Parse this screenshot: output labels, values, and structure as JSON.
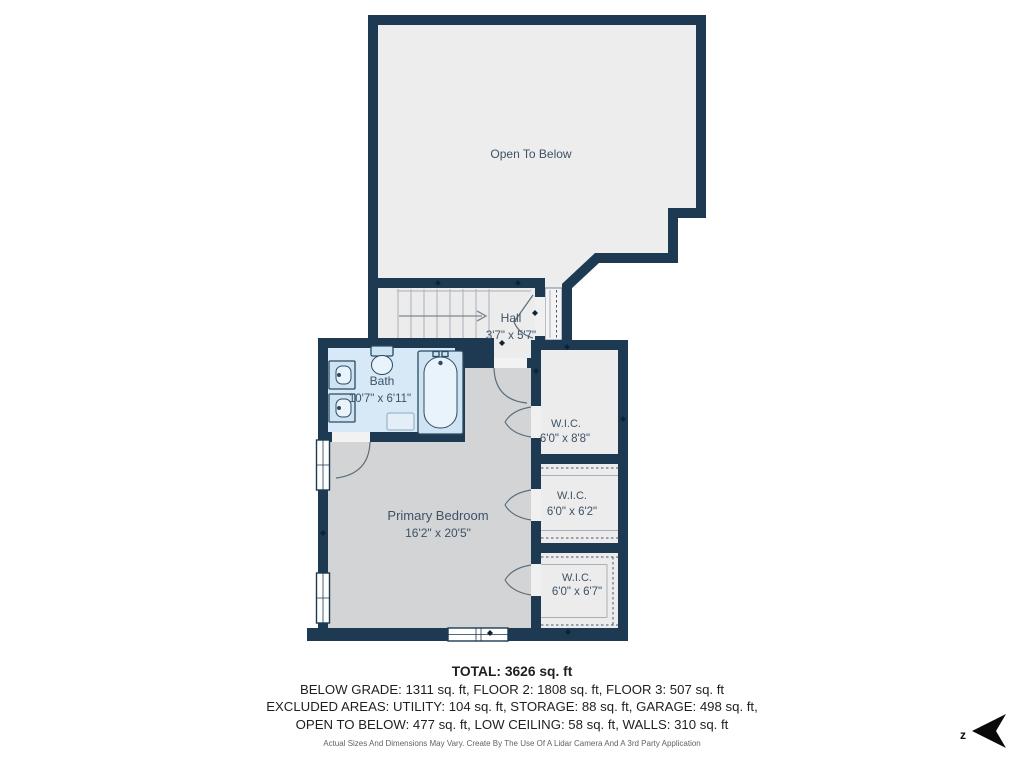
{
  "rooms": {
    "open_below": {
      "label": "Open To Below"
    },
    "hall": {
      "label": "Hall",
      "dims": "3'7\" x 5'7\""
    },
    "bath": {
      "label": "Bath",
      "dims": "10'7\" x 6'11\""
    },
    "primary_bedroom": {
      "label": "Primary Bedroom",
      "dims": "16'2\" x 20'5\""
    },
    "wic1": {
      "label": "W.I.C.",
      "dims": "6'0\" x 8'8\""
    },
    "wic2": {
      "label": "W.I.C.",
      "dims": "6'0\" x 6'2\""
    },
    "wic3": {
      "label": "W.I.C.",
      "dims": "6'0\" x 6'7\""
    }
  },
  "summary": {
    "total": "TOTAL: 3626 sq. ft",
    "floors": "BELOW GRADE: 1311 sq. ft, FLOOR 2: 1808 sq. ft, FLOOR 3: 507 sq. ft",
    "excluded1": "EXCLUDED AREAS: UTILITY: 104 sq. ft, STORAGE: 88 sq. ft, GARAGE: 498 sq. ft,",
    "excluded2": "OPEN TO BELOW: 477 sq. ft, LOW CEILING: 58 sq. ft, WALLS: 310 sq. ft",
    "disclaimer": "Actual Sizes And Dimensions May Vary. Create By The Use Of A Lidar Camera And A 3rd Party Application"
  },
  "compass": {
    "direction_label": "z"
  },
  "colors": {
    "wall": "#1d3a52",
    "open_below_floor": "#ededed",
    "hall_floor": "#ececec",
    "wic_floor": "#ececec",
    "bedroom_floor": "#d3d4d5",
    "bath_floor": "#d7e9f6",
    "room_label_text": "#3e5266",
    "summary_text": "#1f1f1f",
    "disclaimer_text": "#636363"
  }
}
